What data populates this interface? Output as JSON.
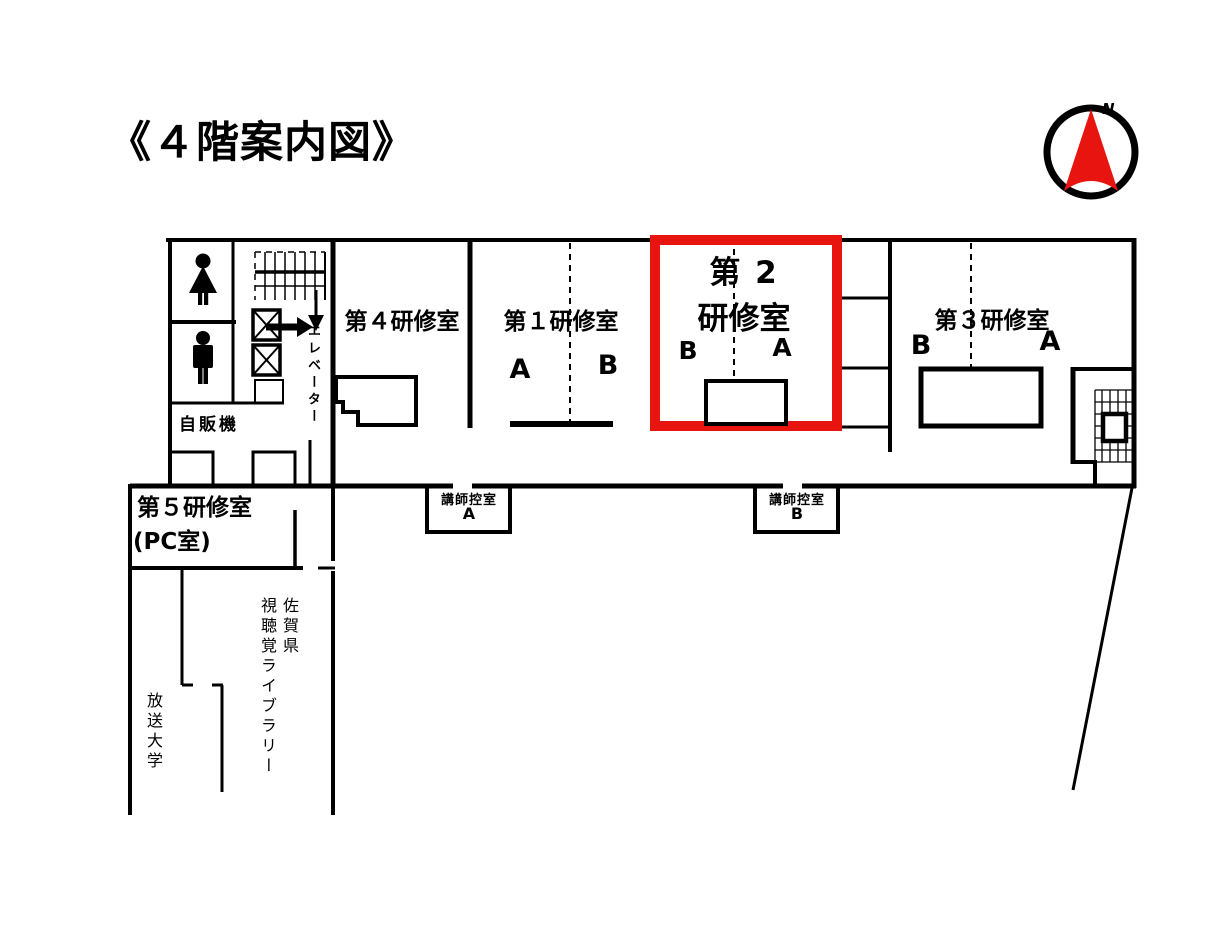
{
  "title": "《４階案内図》",
  "compass": {
    "north_label": "N"
  },
  "colors": {
    "highlight_red": "#e8140f",
    "wall_black": "#000000",
    "background": "#ffffff"
  },
  "rooms": {
    "room4": {
      "name": "第４研修室"
    },
    "room1": {
      "name": "第１研修室",
      "zone_a": "A",
      "zone_b": "B"
    },
    "room2": {
      "name_line1": "第 2",
      "name_line2": "研修室",
      "zone_b": "B",
      "zone_a": "A",
      "highlighted": true
    },
    "room3": {
      "name": "第３研修室",
      "zone_b": "B",
      "zone_a": "A"
    },
    "room5": {
      "name_line1": "第５研修室",
      "name_line2": "(PC室)"
    }
  },
  "labels": {
    "vending_machine": "自販機",
    "elevator": "エレベーター",
    "instructor_room_a_title": "講師控室",
    "instructor_room_a_letter": "A",
    "instructor_room_b_title": "講師控室",
    "instructor_room_b_letter": "B",
    "library_col1": "佐賀県",
    "library_col2": "視聴覚ライブラリー",
    "open_university": "放送大学"
  },
  "icons": {
    "compass": "north-compass-icon",
    "female_restroom": "female-restroom-icon",
    "male_restroom": "male-restroom-icon",
    "upper_stairs": "stairs-icon",
    "stairs_down_arrow": "down-arrow-icon",
    "elevator_entry_arrow": "right-arrow-icon",
    "elevator_shaft": "elevator-shaft-icon",
    "return_stairs": "return-stairs-icon"
  }
}
